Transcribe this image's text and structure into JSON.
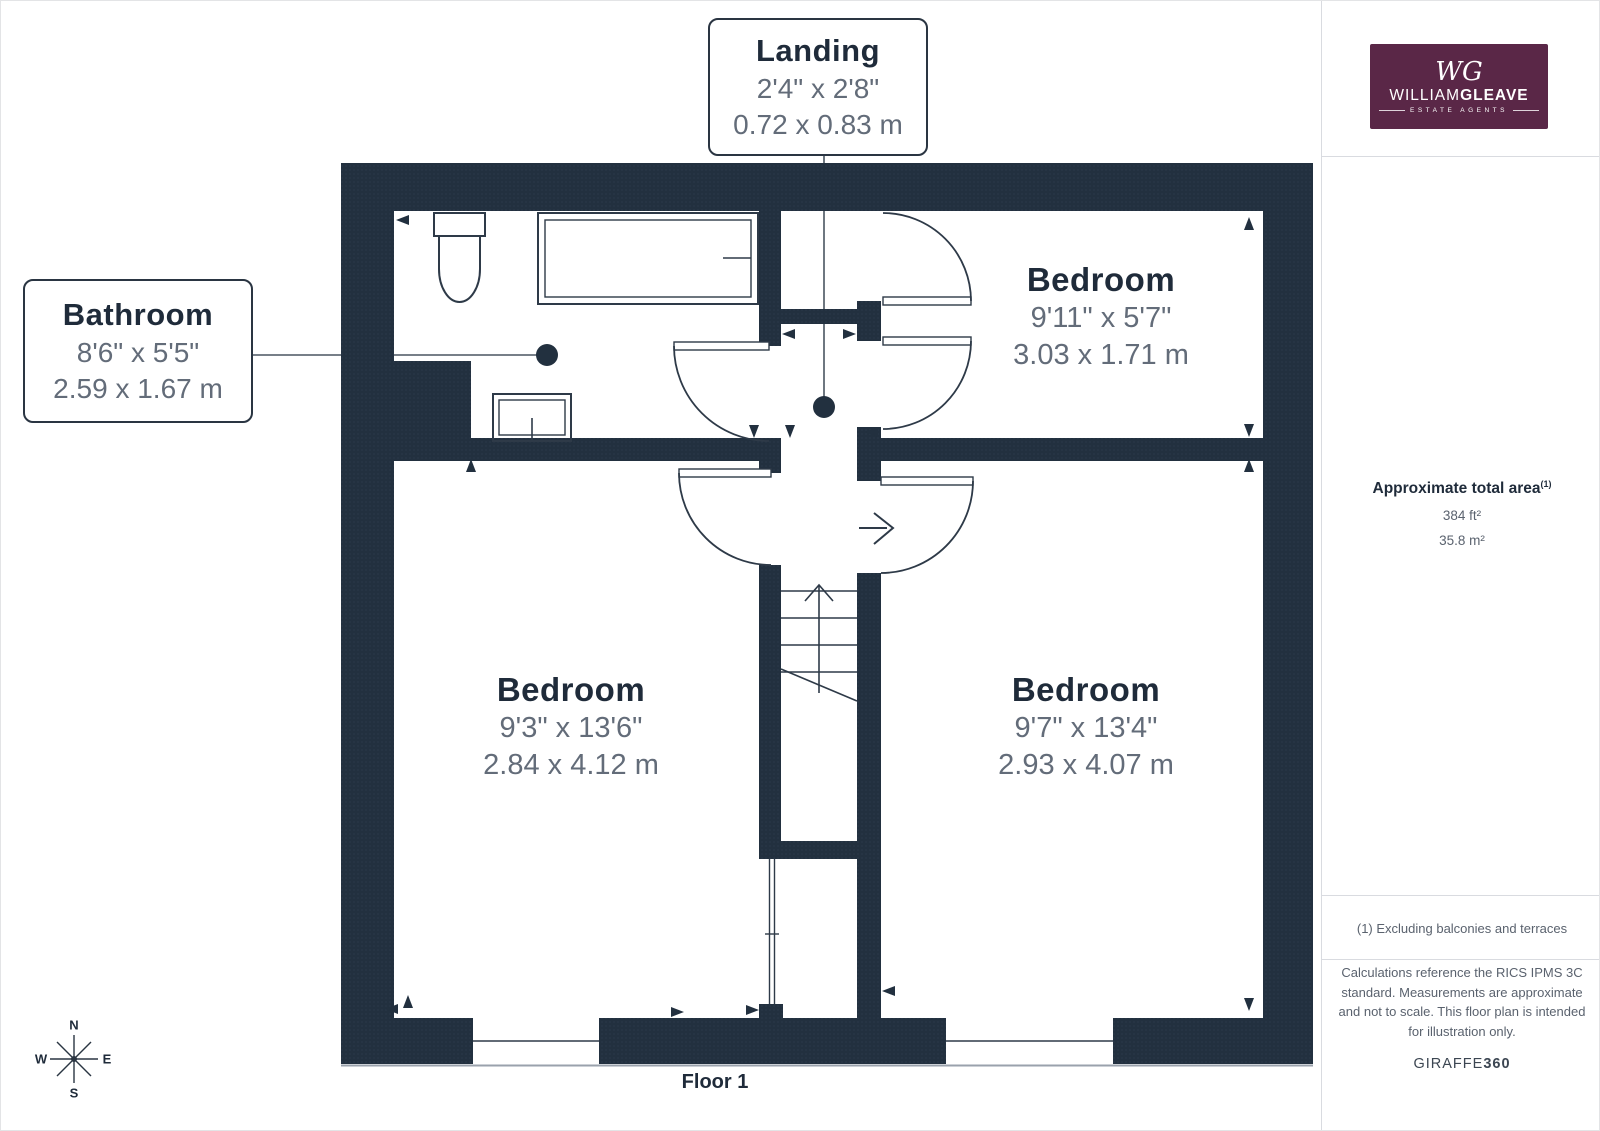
{
  "branding": {
    "monogram": "WG",
    "name_regular": "WILLIAM",
    "name_bold": "GLEAVE",
    "tagline": "ESTATE AGENTS",
    "logo_bg": "#5a2747"
  },
  "sidebar": {
    "area_title": "Approximate total area",
    "area_sup": "(1)",
    "area_ft": "384 ft²",
    "area_m": "35.8 m²",
    "footnote": "(1) Excluding balconies and terraces",
    "disclaimer": "Calculations reference the RICS IPMS 3C standard. Measurements are approximate and not to scale. This floor plan is intended for illustration only.",
    "provider_regular": "GIRAFFE",
    "provider_bold": "360"
  },
  "floor": {
    "label": "Floor 1"
  },
  "compass": {
    "n": "N",
    "e": "E",
    "s": "S",
    "w": "W"
  },
  "rooms": {
    "landing": {
      "name": "Landing",
      "imperial": "2'4\" x 2'8\"",
      "metric": "0.72 x 0.83 m"
    },
    "bathroom": {
      "name": "Bathroom",
      "imperial": "8'6\" x 5'5\"",
      "metric": "2.59 x 1.67 m"
    },
    "bedroom_top": {
      "name": "Bedroom",
      "imperial": "9'11\" x 5'7\"",
      "metric": "3.03 x 1.71 m"
    },
    "bedroom_left": {
      "name": "Bedroom",
      "imperial": "9'3\" x 13'6\"",
      "metric": "2.84 x 4.12 m"
    },
    "bedroom_right": {
      "name": "Bedroom",
      "imperial": "9'7\" x 13'4\"",
      "metric": "2.93 x 4.07 m"
    }
  },
  "colors": {
    "wall": "#22303f",
    "line": "#2e3a48",
    "label_text": "#1f2b3a",
    "dim_text": "#636c79",
    "logo_bg": "#5a2747",
    "divider": "#d9dbe0"
  }
}
